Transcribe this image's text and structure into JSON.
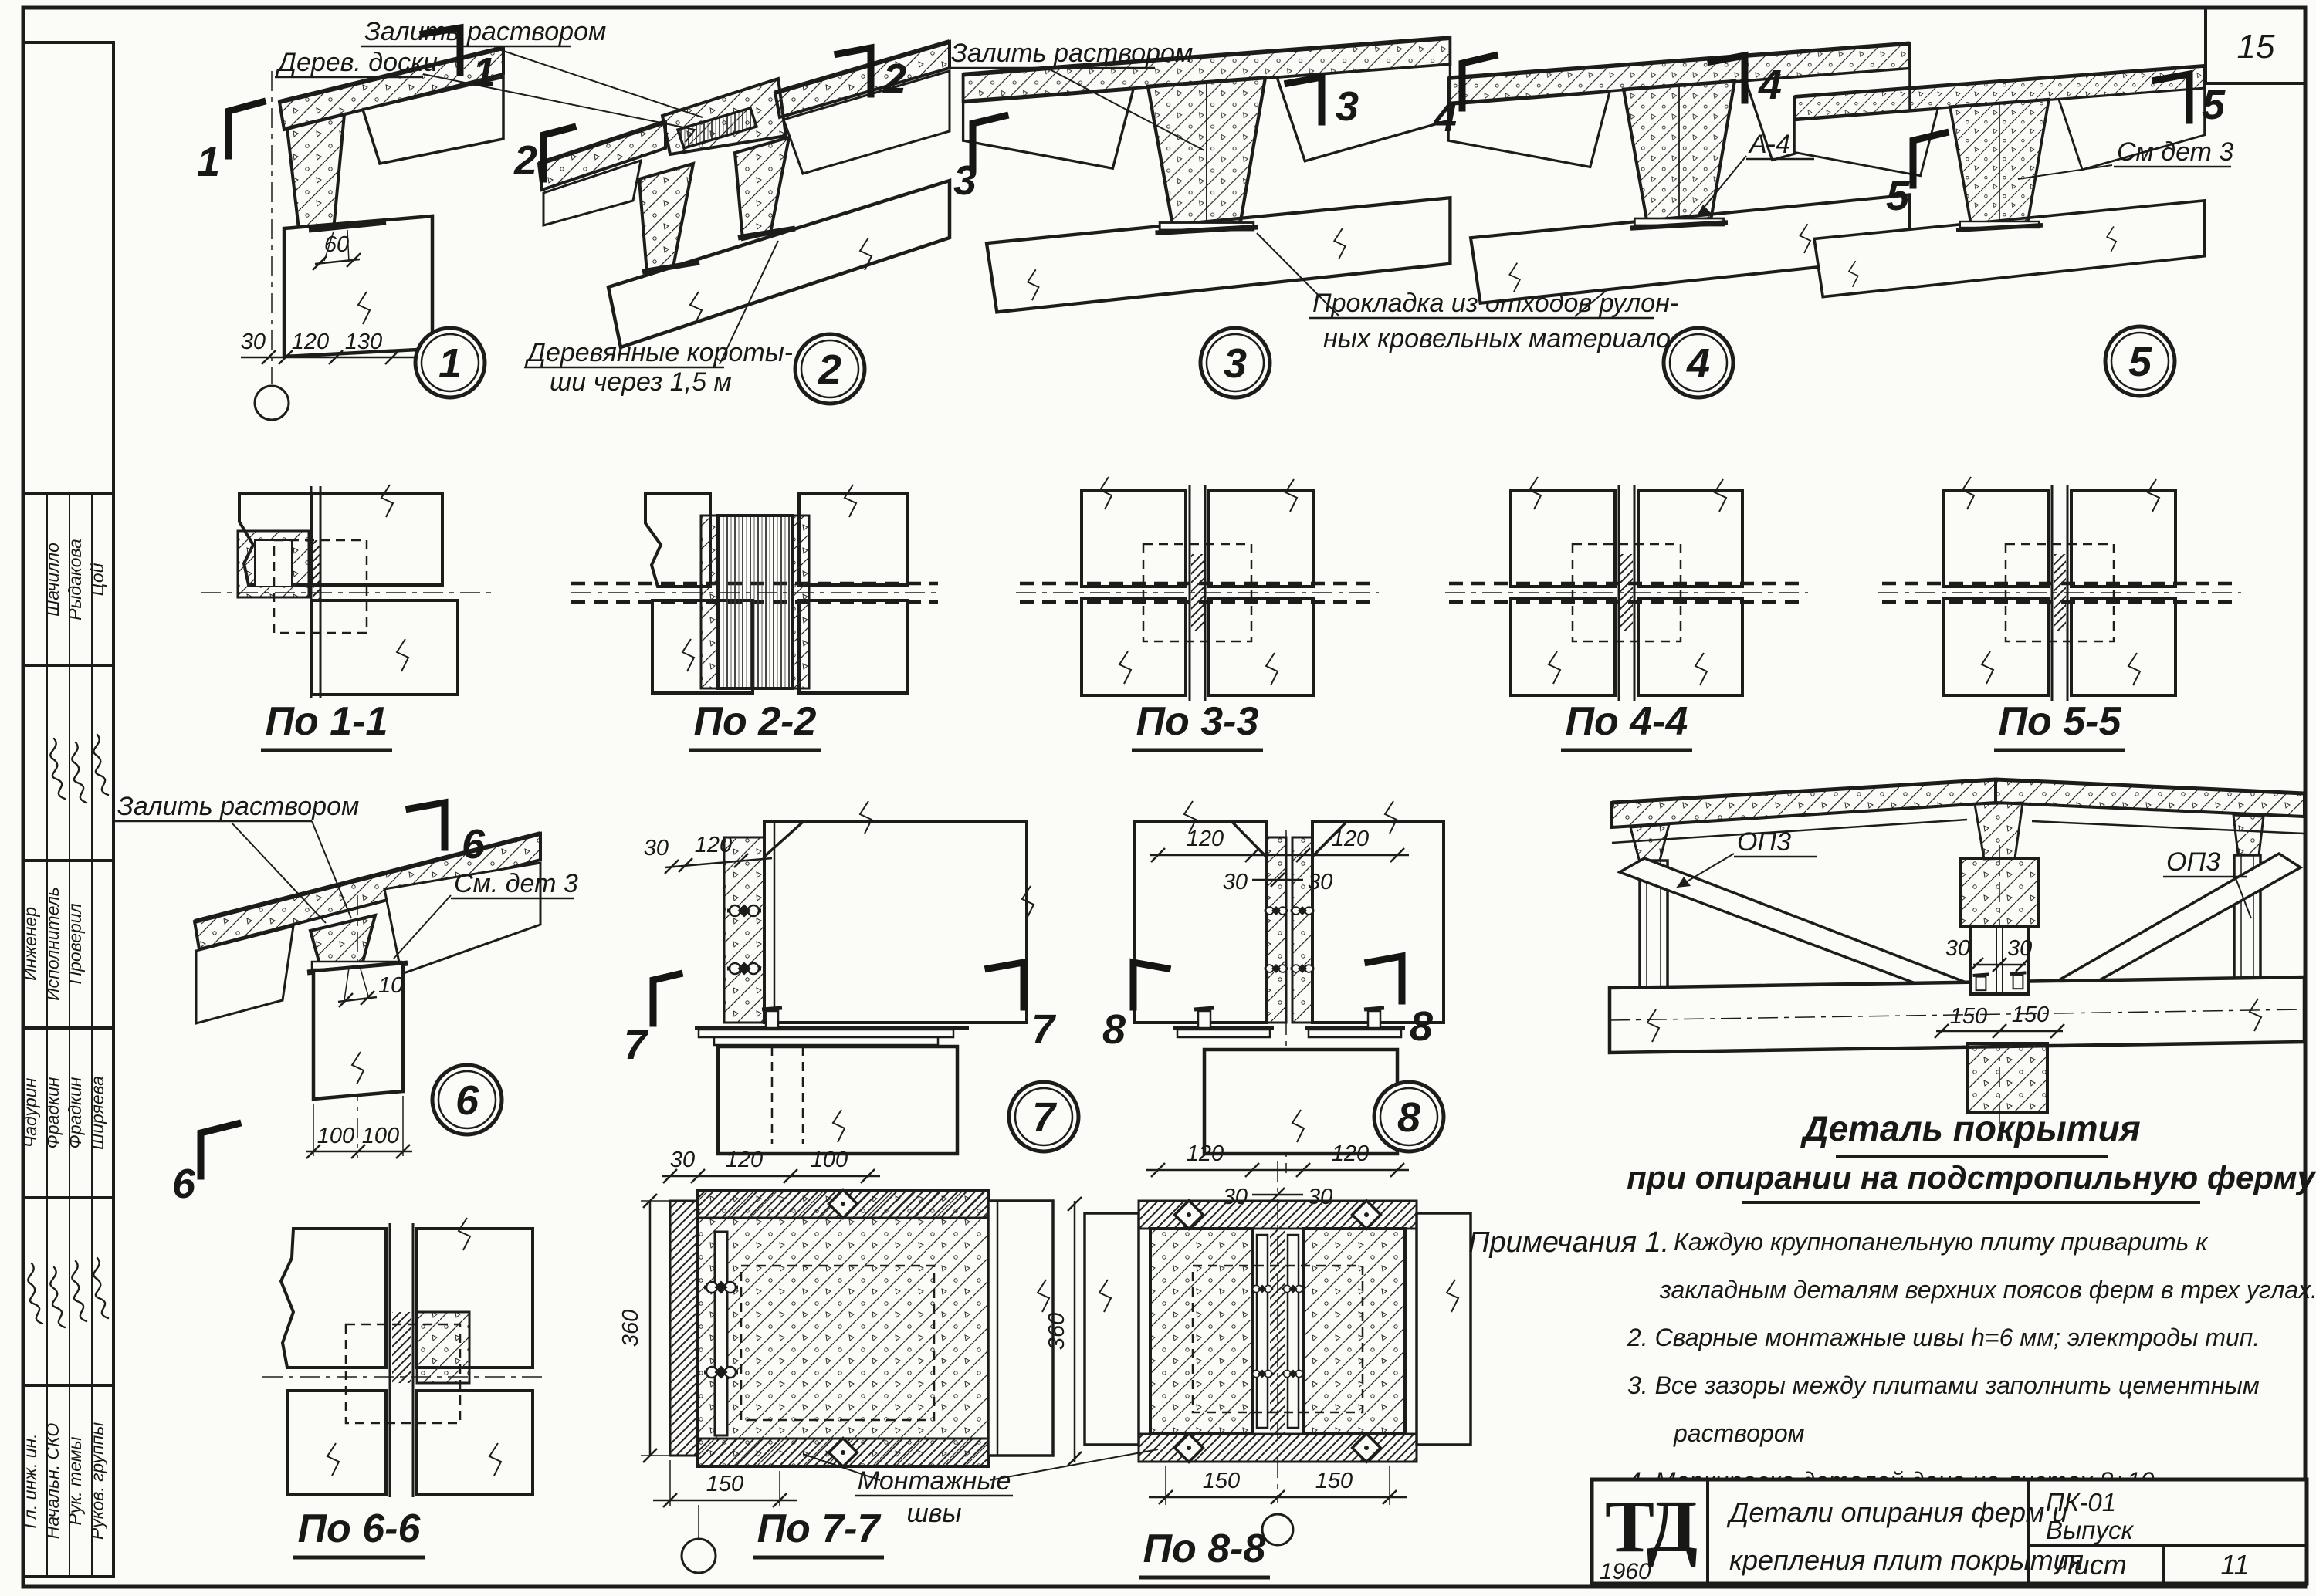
{
  "page": {
    "corner_number": "15"
  },
  "sidebar": {
    "names_top": [
      "Шачилло",
      "Рыдакова",
      "Цой"
    ],
    "titles": [
      "Инженер",
      "Исполнитель",
      "Проверил"
    ],
    "names_mid": [
      "Чадурин",
      "Фрадкин",
      "Фрадкин",
      "Ширяева"
    ],
    "roles": [
      "Гл. инж. ин.",
      "Начальн. СКО",
      "Рук. темы",
      "Руков. группы"
    ]
  },
  "row1": {
    "d1": {
      "num": "1",
      "sec": "1",
      "dim_60": "60",
      "dims_bottom": [
        "30",
        "120",
        "130"
      ]
    },
    "d2": {
      "num": "2",
      "sec": "2",
      "label_mortar": "Залить раствором",
      "label_wood": "Дерев. доски",
      "label_bottom_1": "Деревянные короты-",
      "label_bottom_2": "ши через 1,5 м"
    },
    "d3": {
      "num": "3",
      "sec": "3",
      "label_mortar": "Залить раствором",
      "label_gasket_1": "Прокладка из отходов рулон-",
      "label_gasket_2": "ных кровельных материалов"
    },
    "d4": {
      "num": "4",
      "sec": "4",
      "label_a4": "А-4"
    },
    "d5": {
      "num": "5",
      "sec": "5",
      "label_see": "См дет 3"
    }
  },
  "row2": {
    "s1": "По 1-1",
    "s2": "По 2-2",
    "s3": "По 3-3",
    "s4": "По 4-4",
    "s5": "По 5-5"
  },
  "row3": {
    "d6": {
      "num": "6",
      "sec": "6",
      "label_mortar": "Залить раствором",
      "label_see": "См. дет 3",
      "dim_10": "10",
      "dims_bottom": [
        "100",
        "100"
      ]
    },
    "d7": {
      "num": "7",
      "sec": "7",
      "dims_top": [
        "30",
        "120",
        "100"
      ]
    },
    "d8": {
      "num": "8",
      "sec": "8",
      "dims_top": [
        "120",
        "120"
      ],
      "dims_mid": [
        "30",
        "30"
      ]
    }
  },
  "row4": {
    "s6": "По 6-6",
    "s7": "По 7-7",
    "s8": "По 8-8",
    "p7": {
      "dim_left": "360",
      "dim_bottom": "150"
    },
    "p8": {
      "dim_left": "360",
      "dims_bottom": [
        "150",
        "150"
      ]
    },
    "label_seams_1": "Монтажные",
    "label_seams_2": "швы"
  },
  "big": {
    "label_op3_left": "ОП3",
    "label_op3_right": "ОП3",
    "dims_30": [
      "30",
      "30"
    ],
    "dims_150": [
      "150",
      "150"
    ],
    "title_1": "Деталь покрытия",
    "title_2": "при опирании на подстропильную ферму"
  },
  "notes": {
    "heading": "Примечания 1.",
    "lines": [
      "Каждую крупнопанельную плиту приварить к",
      "закладным деталям верхних поясов ферм в трех углах.",
      "2. Сварные монтажные швы h=6 мм; электроды тип.",
      "3. Все зазоры между плитами заполнить цементным",
      "раствором",
      "4. Маркировка деталей дана на листах 8÷10."
    ]
  },
  "titleblock": {
    "logo": "ТД",
    "year": "1960",
    "title_1": "Детали опирания ферм и",
    "title_2": "крепления плит покрытия",
    "code": "ПК-01",
    "issue": "Выпуск",
    "sheet_label": "Лист",
    "sheet_number": "11"
  }
}
